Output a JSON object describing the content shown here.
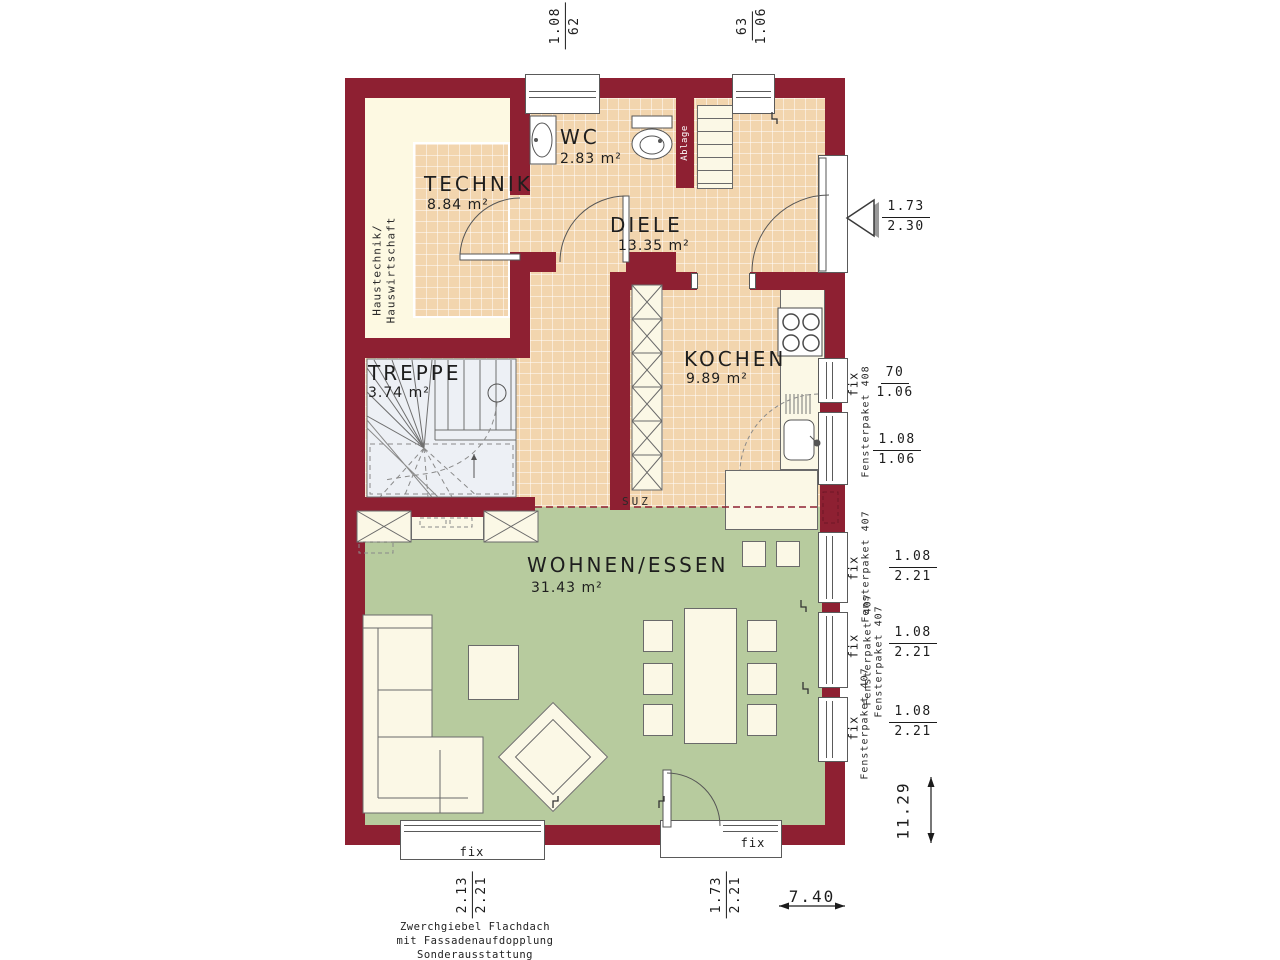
{
  "colors": {
    "wall": "#8e2032",
    "tile": "#f2d5ae",
    "cream": "#fdf9e2",
    "green": "#b7cb9e"
  },
  "rooms": {
    "technik": {
      "name": "TECHNIK",
      "area": "8.84 m²"
    },
    "wc": {
      "name": "WC",
      "area": "2.83 m²"
    },
    "diele": {
      "name": "DIELE",
      "area": "13.35 m²"
    },
    "kochen": {
      "name": "KOCHEN",
      "area": "9.89 m²"
    },
    "treppe": {
      "name": "TREPPE",
      "area": "3.74 m²"
    },
    "wohnen": {
      "name": "WOHNEN/ESSEN",
      "area": "31.43 m²"
    }
  },
  "labels": {
    "fix": "fix",
    "paket408": "Fensterpaket 408",
    "paket407": "Fensterpaket 407",
    "suz": "SUZ",
    "ablage": "Ablage",
    "haustechnik1": "Haustechnik/",
    "haustechnik2": "Hauswirtschaft"
  },
  "dims": {
    "top_left": {
      "a": "1.08",
      "b": "62"
    },
    "top_right": {
      "a": "63",
      "b": "1.06"
    },
    "entrance": {
      "a": "1.73",
      "b": "2.30"
    },
    "kitchen_win1": {
      "a": "70",
      "b": "1.06"
    },
    "kitchen_win2": {
      "a": "1.08",
      "b": "1.06"
    },
    "living_win": {
      "a": "1.08",
      "b": "2.21"
    },
    "bottom_left": {
      "a": "2.13",
      "b": "2.21"
    },
    "bottom_door": {
      "a": "1.73",
      "b": "2.21"
    },
    "total_width": "7.40",
    "total_height": "11.29"
  },
  "footer": {
    "line1": "Zwerchgiebel Flachdach",
    "line2": "mit Fassadenaufdopplung",
    "line3": "Sonderausstattung"
  }
}
